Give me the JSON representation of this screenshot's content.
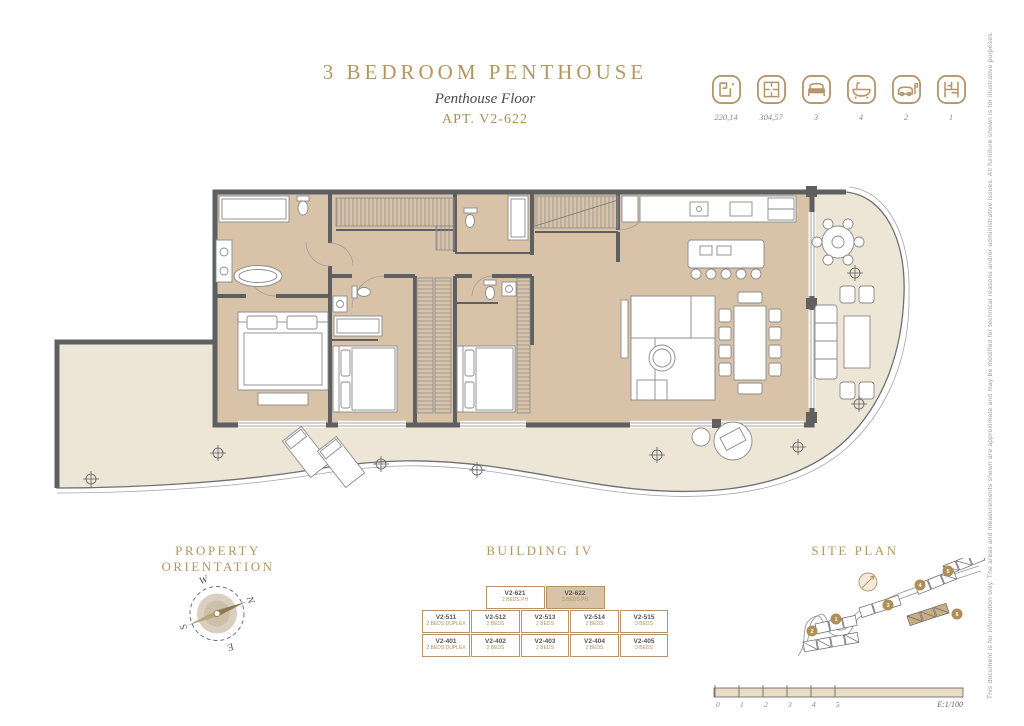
{
  "header": {
    "title": "3 Bedroom Penthouse",
    "subtitle": "Penthouse Floor",
    "apartment": "APT. V2-622"
  },
  "specs": [
    {
      "icon": "interior-area-icon",
      "value": "220,14"
    },
    {
      "icon": "total-area-icon",
      "value": "304,57"
    },
    {
      "icon": "bedrooms-icon",
      "value": "3"
    },
    {
      "icon": "bathrooms-icon",
      "value": "4"
    },
    {
      "icon": "parking-icon",
      "value": "2"
    },
    {
      "icon": "storage-icon",
      "value": "1"
    }
  ],
  "sections": {
    "orientation": "Property Orientation",
    "building": "Building IV",
    "siteplan": "Site Plan"
  },
  "compass": {
    "points": [
      "N",
      "E",
      "S",
      "W"
    ]
  },
  "building_stack": {
    "rows": [
      {
        "cells": [
          {
            "name": "V2-621",
            "type": "2 BEDS PH",
            "highlight": false
          },
          {
            "name": "V2-622",
            "type": "3 BEDS PH",
            "highlight": true
          }
        ]
      },
      {
        "cells": [
          {
            "name": "V2-511",
            "type": "2 BEDS DUPLEX",
            "highlight": false
          },
          {
            "name": "V2-512",
            "type": "2 BEDS",
            "highlight": false
          },
          {
            "name": "V2-513",
            "type": "2 BEDS",
            "highlight": false
          },
          {
            "name": "V2-514",
            "type": "2 BEDS",
            "highlight": false
          },
          {
            "name": "V2-515",
            "type": "3 BEDS",
            "highlight": false
          }
        ]
      },
      {
        "cells": [
          {
            "name": "V2-401",
            "type": "2 BEDS DUPLEX",
            "highlight": false
          },
          {
            "name": "V2-402",
            "type": "2 BEDS",
            "highlight": false
          },
          {
            "name": "V2-403",
            "type": "2 BEDS",
            "highlight": false
          },
          {
            "name": "V2-404",
            "type": "2 BEDS",
            "highlight": false
          },
          {
            "name": "V2-405",
            "type": "3 BEDS",
            "highlight": false
          }
        ]
      }
    ]
  },
  "site_plan": {
    "markers": [
      "1",
      "2",
      "3",
      "4",
      "5",
      "6"
    ]
  },
  "scale_bar": {
    "ticks": [
      "0",
      "1",
      "2",
      "3",
      "4",
      "5"
    ],
    "label": "E:1/100"
  },
  "disclaimer": "This document is for information only. The areas and measurements shown are approximate and may be modified for technical reasons and/or administrative issues. All furniture shown is for illustrative purposes.",
  "colors": {
    "gold": "#b2985f",
    "wall": "#5e5f61",
    "floor": "#d8c3a9",
    "terrace": "#ede5d6"
  }
}
